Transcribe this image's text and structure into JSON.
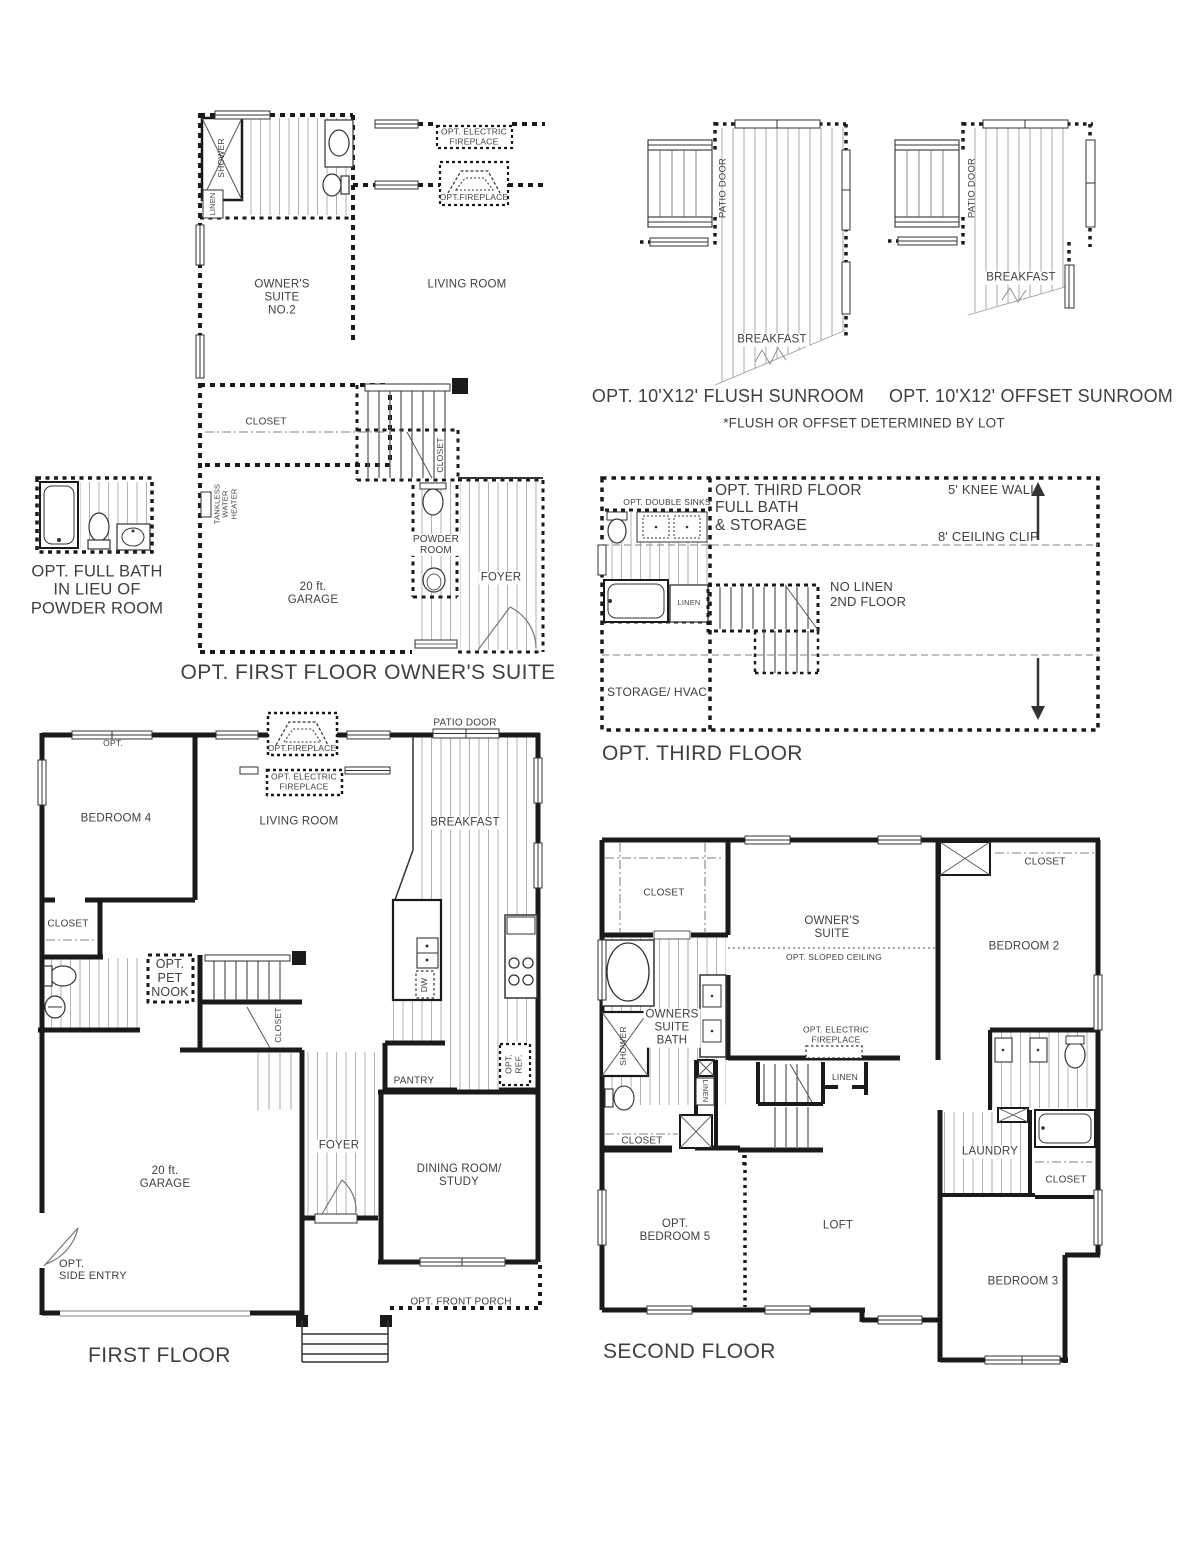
{
  "meta": {
    "sheet_type": "floor-plan-sheet",
    "colors": {
      "wall_ink": "#1a1a1a",
      "hatch": "#b3b3b3",
      "text": "#3f3f3f"
    }
  },
  "plan_owners_suite_opt": {
    "title": "OPT. FIRST FLOOR OWNER'S SUITE",
    "rooms": {
      "owners_suite": "OWNER'S\nSUITE\nNO.2",
      "living_room": "LIVING ROOM",
      "closet": "CLOSET",
      "stair_closet": "CLOSET",
      "powder_room": "POWDER\nROOM",
      "foyer": "FOYER",
      "garage": "20 ft.\nGARAGE"
    },
    "labels": {
      "shower": "SHOWER",
      "linen": "LINEN",
      "tankless": "TANKLESS\nWATER\nHEATER",
      "opt_electric_fireplace": "OPT. ELECTRIC\nFIREPLACE",
      "opt_fireplace": "OPT.FIREPLACE"
    }
  },
  "plan_full_bath_opt": {
    "title": "OPT. FULL BATH\nIN LIEU OF\nPOWDER ROOM"
  },
  "sunrooms": {
    "flush": {
      "title": "OPT. 10'X12' FLUSH SUNROOM",
      "patio_door": "PATIO DOOR",
      "breakfast": "BREAKFAST"
    },
    "offset": {
      "title": "OPT. 10'X12' OFFSET SUNROOM",
      "patio_door": "PATIO DOOR",
      "breakfast": "BREAKFAST"
    },
    "note": "*FLUSH OR OFFSET DETERMINED BY LOT"
  },
  "plan_third_floor": {
    "title": "OPT. THIRD FLOOR",
    "labels": {
      "opt_double_sinks": "OPT. DOUBLE SINKS",
      "full_bath_storage": "OPT. THIRD FLOOR\nFULL BATH\n& STORAGE",
      "knee_wall": "5' KNEE WALL",
      "ceiling_clip": "8' CEILING CLIP",
      "linen": "LINEN",
      "no_linen": "NO LINEN\n2ND FLOOR",
      "storage_hvac": "STORAGE/ HVAC"
    }
  },
  "plan_first_floor": {
    "title": "FIRST FLOOR",
    "rooms": {
      "bedroom4": "BEDROOM 4",
      "living_room": "LIVING ROOM",
      "breakfast": "BREAKFAST",
      "closet": "CLOSET",
      "stair_closet": "CLOSET",
      "pantry": "PANTRY",
      "foyer": "FOYER",
      "dining_study": "DINING ROOM/\nSTUDY",
      "garage": "20 ft.\nGARAGE"
    },
    "labels": {
      "patio_door": "PATIO DOOR",
      "opt_fireplace": "OPT.FIREPLACE",
      "opt_electric_fireplace": "OPT. ELECTRIC\nFIREPLACE",
      "opt_window": "OPT.",
      "opt_pet_nook": "OPT.\nPET\nNOOK",
      "dw": "DW",
      "opt_ref": "OPT.\nREF.",
      "opt_side_entry": "OPT.\nSIDE ENTRY",
      "opt_front_porch": "OPT. FRONT PORCH"
    }
  },
  "plan_second_floor": {
    "title": "SECOND FLOOR",
    "rooms": {
      "owners_suite": "OWNER'S\nSUITE",
      "owners_suite_bath": "OWNERS\nSUITE\nBATH",
      "bedroom2": "BEDROOM 2",
      "bedroom3": "BEDROOM 3",
      "opt_bedroom5": "OPT.\nBEDROOM 5",
      "loft": "LOFT",
      "laundry": "LAUNDRY",
      "closet_owners": "CLOSET",
      "closet_bedroom2": "CLOSET",
      "closet_bedroom5": "CLOSET",
      "closet_bedroom3": "CLOSET"
    },
    "labels": {
      "opt_sloped_ceiling": "OPT. SLOPED CEILING",
      "opt_electric_fireplace": "OPT. ELECTRIC\nFIREPLACE",
      "shower": "SHOWER",
      "linen": "LINEN",
      "linen_small": "LINEN"
    }
  }
}
